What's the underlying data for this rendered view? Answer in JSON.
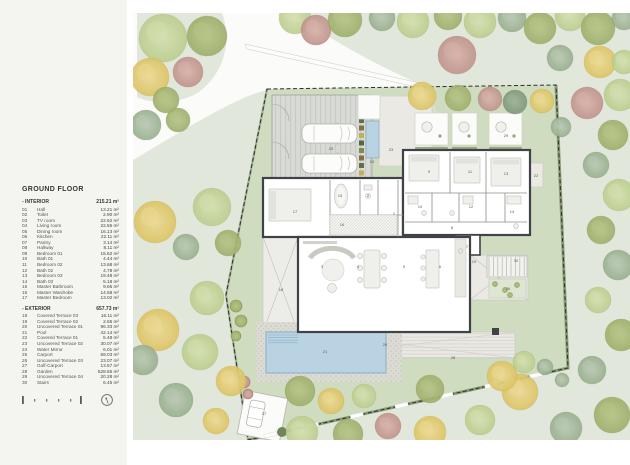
{
  "legend": {
    "title": "GROUND FLOOR",
    "interior_label": "- INTERIOR",
    "interior_total": "215.21 m²",
    "exterior_label": "- EXTERIOR",
    "exterior_total": "657.73 m²",
    "interior_rows": [
      {
        "num": "01",
        "name": "Hall",
        "area": "13.21 m²"
      },
      {
        "num": "02",
        "name": "Toilet",
        "area": "2.90 m²"
      },
      {
        "num": "03",
        "name": "TV room",
        "area": "22.62 m²"
      },
      {
        "num": "04",
        "name": "Living room",
        "area": "22.56 m²"
      },
      {
        "num": "05",
        "name": "Dining room",
        "area": "16.13 m²"
      },
      {
        "num": "06",
        "name": "Kitchen",
        "area": "22.11 m²"
      },
      {
        "num": "07",
        "name": "Pantry",
        "area": "3.14 m²"
      },
      {
        "num": "08",
        "name": "Hallway",
        "area": "8.11 m²"
      },
      {
        "num": "09",
        "name": "Bedroom 01",
        "area": "15.62 m²"
      },
      {
        "num": "10",
        "name": "Bath 01",
        "area": "4.44 m²"
      },
      {
        "num": "11",
        "name": "Bedroom 02",
        "area": "13.68 m²"
      },
      {
        "num": "12",
        "name": "Bath 02",
        "area": "4.78 m²"
      },
      {
        "num": "13",
        "name": "Bedroom 03",
        "area": "19.48 m²"
      },
      {
        "num": "14",
        "name": "Bath 03",
        "area": "5.18 m²"
      },
      {
        "num": "15",
        "name": "Master Bathroom",
        "area": "9.65 m²"
      },
      {
        "num": "16",
        "name": "Master Wardrobe",
        "area": "14.68 m²"
      },
      {
        "num": "17",
        "name": "Master Bedroom",
        "area": "13.02 m²"
      }
    ],
    "exterior_rows": [
      {
        "num": "18",
        "name": "Covered Terrace 03",
        "area": "16.11 m²"
      },
      {
        "num": "19",
        "name": "Covered Terrace 02",
        "area": "2.65 m²"
      },
      {
        "num": "20",
        "name": "Uncovered Terrace 01",
        "area": "96.33 m²"
      },
      {
        "num": "21",
        "name": "Pool",
        "area": "42.14 m²"
      },
      {
        "num": "22",
        "name": "Covered Terrace 01",
        "area": "5.48 m²"
      },
      {
        "num": "23",
        "name": "Uncovered Terrace 02",
        "area": "30.07 m²"
      },
      {
        "num": "24",
        "name": "Water Mirror",
        "area": "6.01 m²"
      },
      {
        "num": "25",
        "name": "Carport",
        "area": "69.03 m²"
      },
      {
        "num": "26",
        "name": "Uncovered Terrace 03",
        "area": "23.07 m²"
      },
      {
        "num": "27",
        "name": "Golf-Carport",
        "area": "13.57 m²"
      },
      {
        "num": "28",
        "name": "Garden",
        "area": "528.65 m²"
      },
      {
        "num": "29",
        "name": "Uncovered Terrace 04",
        "area": "20.28 m²"
      },
      {
        "num": "30",
        "name": "Stairs",
        "area": "6.45 m²"
      }
    ]
  },
  "map": {
    "colors": {
      "bg": "#e2e7dc",
      "lawn": "#cfdcc0",
      "road": "#fbfbfa",
      "wall": "#3f4347",
      "pool": "#b9d3e2",
      "poolEdge": "#8aaec4",
      "deck": "#e9e8e2",
      "gravel": "#dcdbd3",
      "carport": "#d8dad5",
      "hedge": "#76895f",
      "terr": "#eae9e4",
      "label": "#5a5d54",
      "furn": "#eff0ec",
      "furnEdge": "#c6c6c0",
      "path": "#d8e0ca"
    },
    "tree_palette": {
      "pg": [
        "#d3dfae",
        "#bcce90",
        "#9fb474"
      ],
      "ol": [
        "#b6c487",
        "#9fb06c",
        "#84955a"
      ],
      "sg": [
        "#b8c8b2",
        "#9ab08f",
        "#7e9678"
      ],
      "dsg": [
        "#9cb196",
        "#81997c",
        "#6a8266"
      ],
      "yl": [
        "#ecd993",
        "#dcc465",
        "#c2a94e"
      ],
      "pk": [
        "#d7b2aa",
        "#c0948c",
        "#a67a72"
      ]
    },
    "boundary": [
      [
        267,
        89
      ],
      [
        556,
        85
      ],
      [
        568,
        368
      ],
      [
        248,
        440
      ],
      [
        226,
        295
      ]
    ],
    "trees": [
      [
        163,
        38,
        24,
        "pg"
      ],
      [
        207,
        36,
        20,
        "ol"
      ],
      [
        150,
        77,
        19,
        "yl"
      ],
      [
        188,
        72,
        15,
        "pk"
      ],
      [
        166,
        100,
        13,
        "ol"
      ],
      [
        146,
        125,
        15,
        "sg"
      ],
      [
        178,
        120,
        12,
        "ol"
      ],
      [
        212,
        207,
        19,
        "pg"
      ],
      [
        155,
        222,
        21,
        "yl"
      ],
      [
        186,
        247,
        13,
        "sg"
      ],
      [
        228,
        243,
        13,
        "ol"
      ],
      [
        207,
        298,
        17,
        "pg"
      ],
      [
        158,
        330,
        21,
        "yl"
      ],
      [
        200,
        352,
        18,
        "pg"
      ],
      [
        143,
        360,
        15,
        "sg"
      ],
      [
        231,
        381,
        15,
        "yl"
      ],
      [
        176,
        400,
        17,
        "sg"
      ],
      [
        216,
        421,
        13,
        "yl"
      ],
      [
        295,
        18,
        16,
        "pg"
      ],
      [
        316,
        30,
        15,
        "pk"
      ],
      [
        345,
        20,
        17,
        "ol"
      ],
      [
        382,
        18,
        13,
        "sg"
      ],
      [
        413,
        22,
        16,
        "pg"
      ],
      [
        448,
        16,
        14,
        "ol"
      ],
      [
        457,
        55,
        19,
        "pk"
      ],
      [
        480,
        22,
        16,
        "pg"
      ],
      [
        512,
        18,
        14,
        "sg"
      ],
      [
        540,
        28,
        16,
        "ol"
      ],
      [
        570,
        16,
        15,
        "pg"
      ],
      [
        598,
        28,
        17,
        "ol"
      ],
      [
        624,
        18,
        12,
        "sg"
      ],
      [
        600,
        62,
        16,
        "yl"
      ],
      [
        560,
        58,
        13,
        "sg"
      ],
      [
        624,
        62,
        12,
        "pg"
      ],
      [
        620,
        95,
        16,
        "pg"
      ],
      [
        587,
        103,
        16,
        "pk"
      ],
      [
        422,
        96,
        14,
        "yl"
      ],
      [
        458,
        98,
        13,
        "ol"
      ],
      [
        490,
        99,
        12,
        "pk"
      ],
      [
        515,
        102,
        12,
        "dsg"
      ],
      [
        542,
        101,
        12,
        "yl"
      ],
      [
        561,
        127,
        10,
        "sg"
      ],
      [
        613,
        135,
        15,
        "ol"
      ],
      [
        596,
        165,
        13,
        "sg"
      ],
      [
        619,
        195,
        16,
        "pg"
      ],
      [
        601,
        230,
        14,
        "ol"
      ],
      [
        618,
        265,
        15,
        "sg"
      ],
      [
        598,
        300,
        13,
        "pg"
      ],
      [
        621,
        335,
        16,
        "ol"
      ],
      [
        592,
        370,
        14,
        "sg"
      ],
      [
        612,
        415,
        18,
        "ol"
      ],
      [
        566,
        428,
        16,
        "sg"
      ],
      [
        520,
        392,
        18,
        "yl"
      ],
      [
        545,
        367,
        8,
        "sg"
      ],
      [
        480,
        420,
        15,
        "pg"
      ],
      [
        430,
        432,
        16,
        "yl"
      ],
      [
        388,
        426,
        13,
        "pk"
      ],
      [
        348,
        434,
        15,
        "ol"
      ],
      [
        302,
        432,
        16,
        "pg"
      ],
      [
        300,
        391,
        15,
        "ol"
      ],
      [
        331,
        401,
        13,
        "yl"
      ],
      [
        364,
        396,
        12,
        "pg"
      ],
      [
        430,
        389,
        14,
        "ol"
      ],
      [
        502,
        376,
        15,
        "yl"
      ],
      [
        524,
        362,
        11,
        "pg"
      ],
      [
        562,
        380,
        7,
        "sg"
      ]
    ],
    "room_labels": [
      {
        "n": "1",
        "x": 394,
        "y": 215
      },
      {
        "n": "2",
        "x": 368,
        "y": 197
      },
      {
        "n": "3",
        "x": 322,
        "y": 268
      },
      {
        "n": "4",
        "x": 358,
        "y": 268
      },
      {
        "n": "5",
        "x": 404,
        "y": 268
      },
      {
        "n": "6",
        "x": 440,
        "y": 268
      },
      {
        "n": "7",
        "x": 467,
        "y": 248
      },
      {
        "n": "8",
        "x": 452,
        "y": 229
      },
      {
        "n": "9",
        "x": 429,
        "y": 173
      },
      {
        "n": "10",
        "x": 420,
        "y": 208
      },
      {
        "n": "11",
        "x": 470,
        "y": 173
      },
      {
        "n": "12",
        "x": 471,
        "y": 208
      },
      {
        "n": "13",
        "x": 506,
        "y": 175
      },
      {
        "n": "14",
        "x": 512,
        "y": 213
      },
      {
        "n": "15",
        "x": 340,
        "y": 197
      },
      {
        "n": "16",
        "x": 342,
        "y": 226
      },
      {
        "n": "17",
        "x": 295,
        "y": 213
      },
      {
        "n": "18",
        "x": 281,
        "y": 291
      },
      {
        "n": "19",
        "x": 474,
        "y": 263
      },
      {
        "n": "20",
        "x": 385,
        "y": 346
      },
      {
        "n": "21",
        "x": 325,
        "y": 353
      },
      {
        "n": "22",
        "x": 536,
        "y": 177
      },
      {
        "n": "23",
        "x": 391,
        "y": 151
      },
      {
        "n": "24",
        "x": 372,
        "y": 163
      },
      {
        "n": "25",
        "x": 331,
        "y": 150
      },
      {
        "n": "26",
        "x": 508,
        "y": 290
      },
      {
        "n": "27",
        "x": 264,
        "y": 415
      },
      {
        "n": "28",
        "x": 453,
        "y": 359
      },
      {
        "n": "29",
        "x": 506,
        "y": 137
      },
      {
        "n": "30",
        "x": 516,
        "y": 262
      }
    ]
  }
}
